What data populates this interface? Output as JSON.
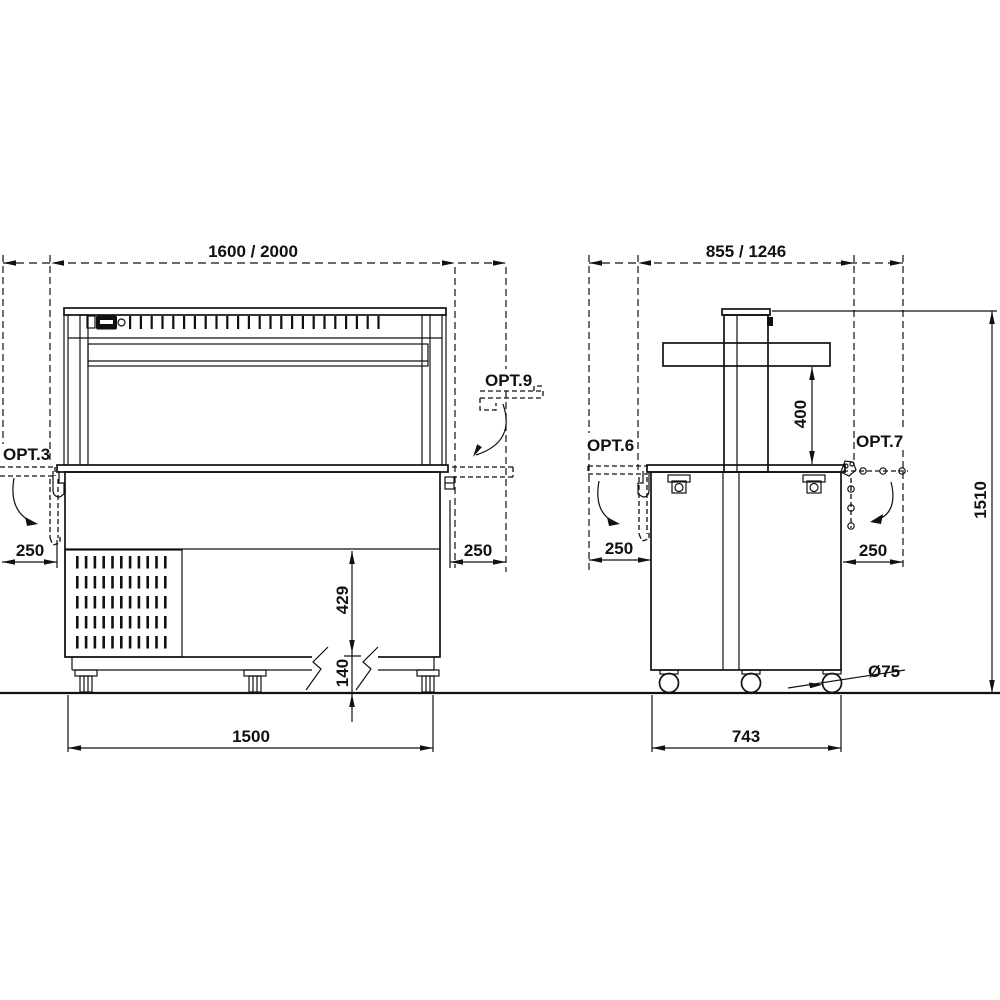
{
  "drawing": {
    "front": {
      "dim_total": "1600 / 2000",
      "dim_body": "1500",
      "dim_shelf_left": "250",
      "dim_shelf_right": "250",
      "dim_upper_height": "429",
      "dim_base_height": "140",
      "opt_left_label": "OPT.3",
      "opt_right_label": "OPT.9"
    },
    "side": {
      "dim_total": "855 / 1246",
      "dim_body": "743",
      "dim_shelf_left": "250",
      "dim_shelf_right": "250",
      "dim_overshelf_height": "400",
      "dim_total_height": "1510",
      "dim_caster_diameter": "Ø75",
      "opt_left_label": "OPT.6",
      "opt_right_label": "OPT.7"
    }
  }
}
